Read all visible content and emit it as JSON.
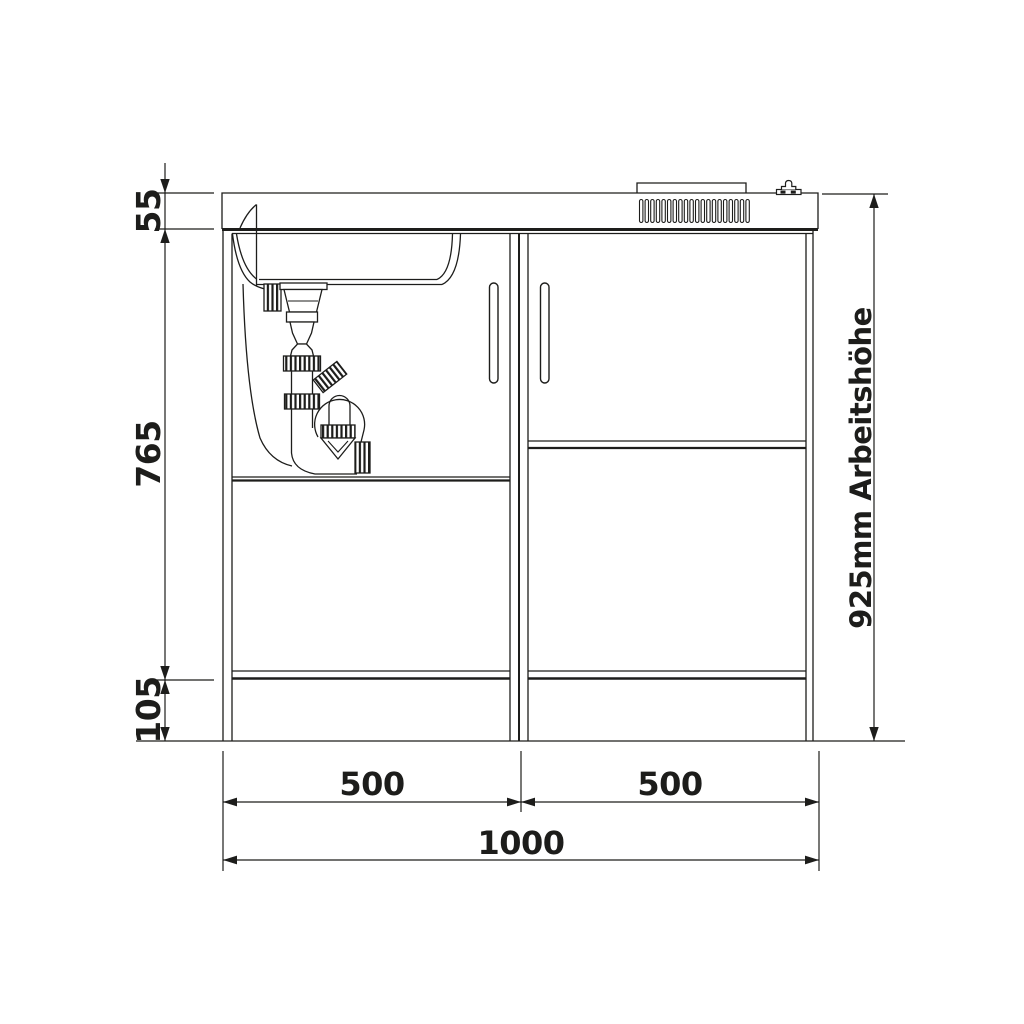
{
  "title": "Kitchenette front elevation technical drawing",
  "colors": {
    "background": "#ffffff",
    "line": "#1d1d1b"
  },
  "dimensions": {
    "worktop_thickness": "55",
    "cabinet_height": "765",
    "plinth_height": "105",
    "left_module_width": "500",
    "right_module_width": "500",
    "total_width": "1000",
    "working_height": "925mm Arbeitshöhe"
  },
  "grille": {
    "slat_count": 20
  }
}
